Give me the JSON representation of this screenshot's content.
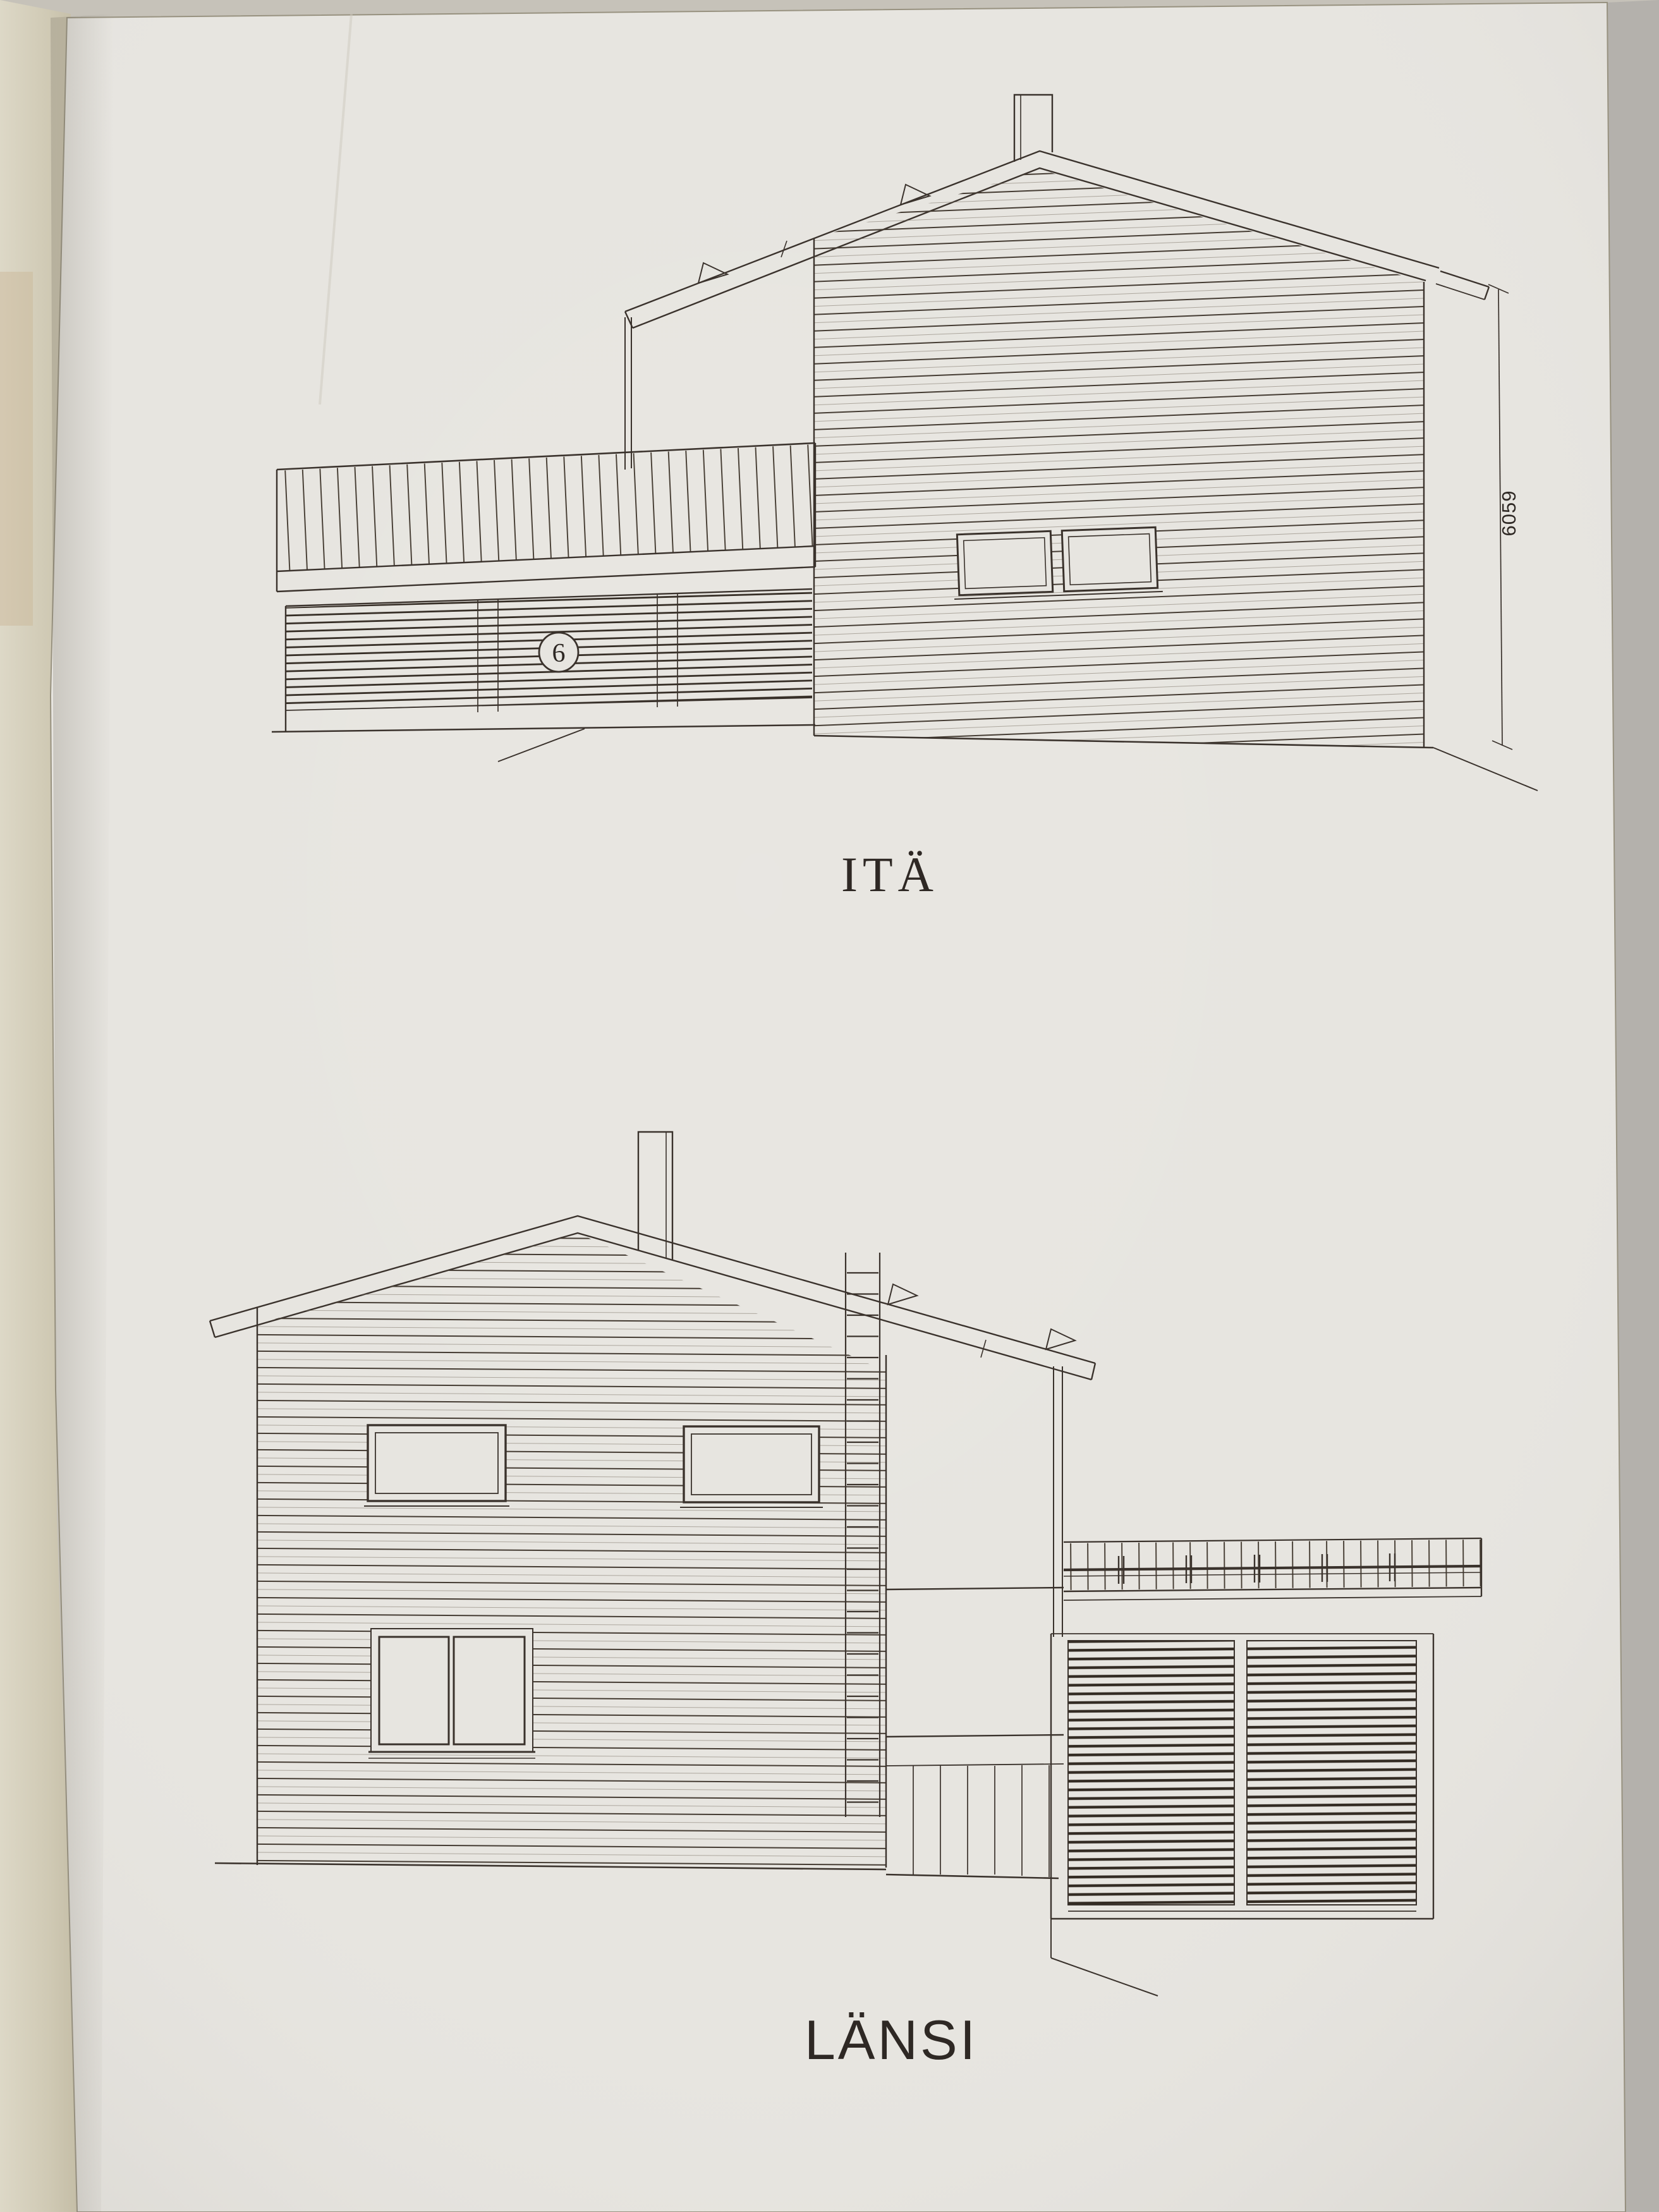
{
  "document": {
    "kind": "architectural-elevation-sheet-photo",
    "elevations": [
      {
        "id": "east",
        "label": "ITÄ",
        "detail_marker": "6",
        "height_dimension": "6059"
      },
      {
        "id": "west",
        "label": "LÄNSI"
      }
    ]
  },
  "drawings": {
    "top": {
      "label": "ITÄ",
      "detail_marker": "6",
      "dimension": "6059"
    },
    "bottom": {
      "label": "LÄNSI"
    }
  },
  "colors": {
    "ink": "#3a322c",
    "ink_dark": "#2e2824",
    "paper": "#e7e5e0",
    "background": "#c6c2b9",
    "table_surface": "#d5d0bd"
  }
}
